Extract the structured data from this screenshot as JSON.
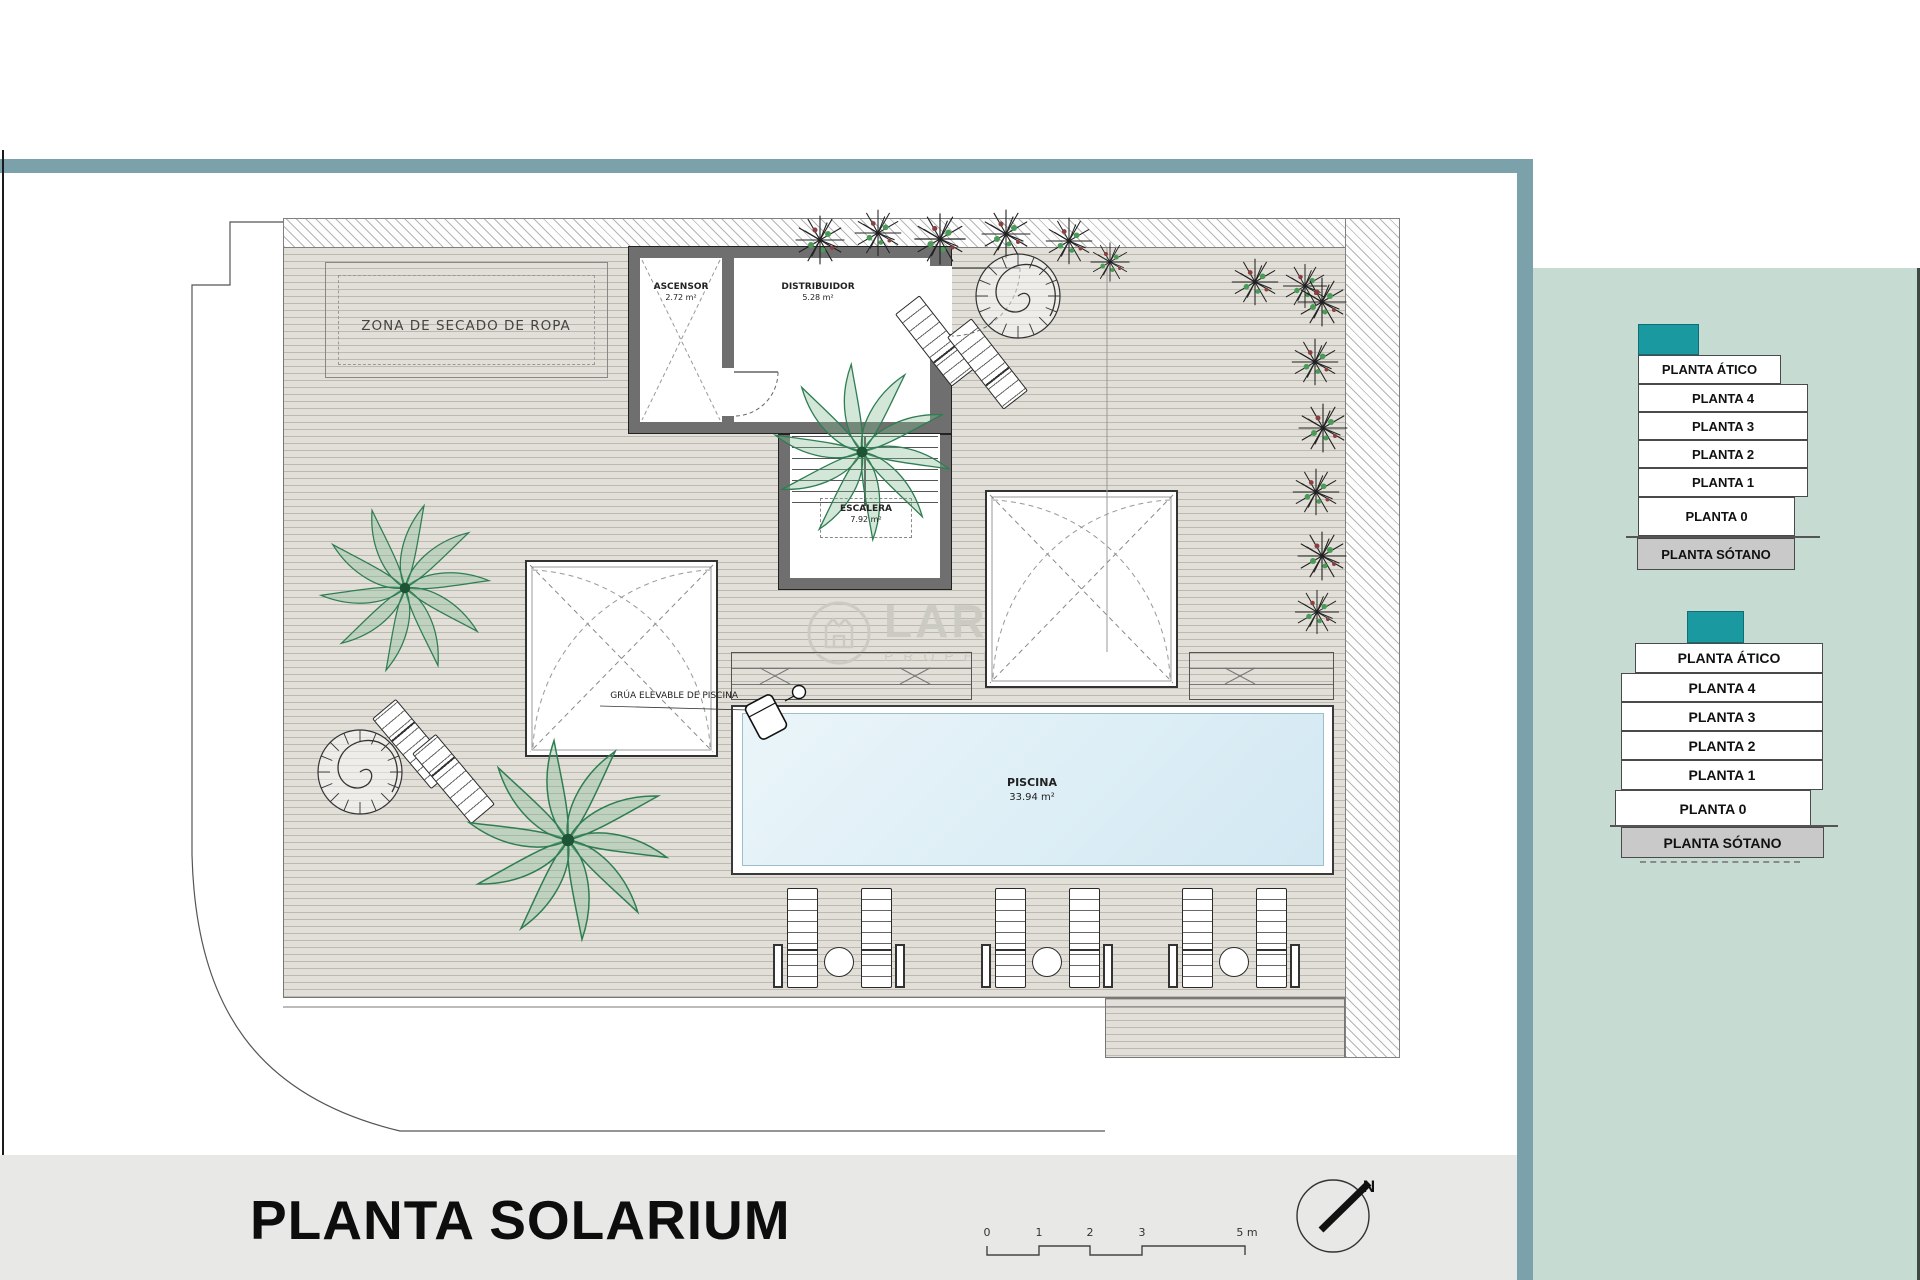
{
  "page": {
    "title": "PLANTA SOLARIUM"
  },
  "watermark": {
    "line1": "LARRO",
    "line2": "PROPERT"
  },
  "plan": {
    "zona_secado": "ZONA DE SECADO DE ROPA",
    "ascensor": {
      "name": "ASCENSOR",
      "area": "2.72 m²"
    },
    "distribuidor": {
      "name": "DISTRIBUIDOR",
      "area": "5.28 m²"
    },
    "escalera": {
      "name": "ESCALERA",
      "area": "7.92 m²"
    },
    "piscina": {
      "name": "PISCINA",
      "area": "33.94 m²"
    },
    "grua": "GRÚA ELEVABLE DE PISCINA"
  },
  "scale_bar": {
    "ticks": [
      "0",
      "1",
      "2",
      "3",
      "5 m"
    ]
  },
  "north_label": "N",
  "stacks": [
    {
      "levels": [
        "PLANTA ÁTICO",
        "PLANTA 4",
        "PLANTA 3",
        "PLANTA 2",
        "PLANTA 1",
        "PLANTA 0",
        "PLANTA SÓTANO"
      ]
    },
    {
      "levels": [
        "PLANTA ÁTICO",
        "PLANTA 4",
        "PLANTA 3",
        "PLANTA 2",
        "PLANTA 1",
        "PLANTA 0",
        "PLANTA SÓTANO"
      ]
    }
  ],
  "colors": {
    "accent_teal": "#1b99a1",
    "frame_teal": "#7ba2ab",
    "panel_sage": "#c6dbd2",
    "footer_gray": "#e8e8e6",
    "pool_blue": "#ddeef6",
    "deck_beige": "#e1dfd7",
    "sotano_gray": "#c9c9c9"
  }
}
